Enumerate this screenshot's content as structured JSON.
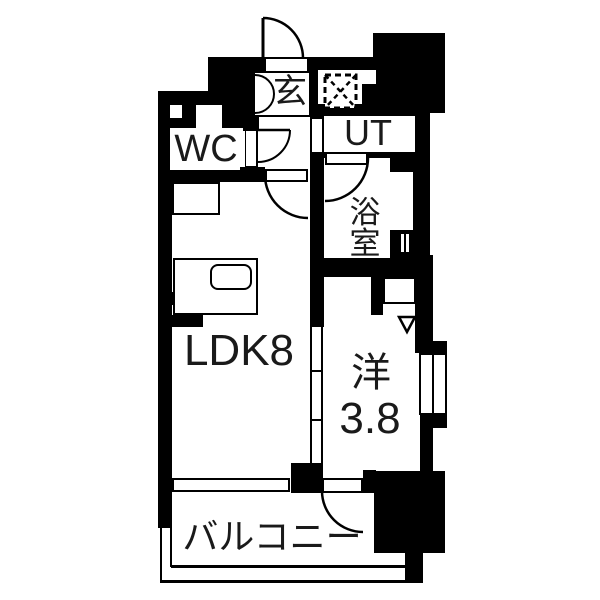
{
  "floorplan": {
    "labels": {
      "genkan": "玄",
      "wc": "WC",
      "ut": "UT",
      "bath": "浴室",
      "ldk": "LDK8",
      "western_name": "洋",
      "western_size": "3.8",
      "balcony": "バルコニー"
    },
    "colors": {
      "wall": "#000000",
      "floor": "#ffffff"
    },
    "symbols": {
      "shaft_marker": "dashed-x-box",
      "appliance_marker": "down-triangle",
      "doors": "quarter-arc-swing"
    }
  }
}
